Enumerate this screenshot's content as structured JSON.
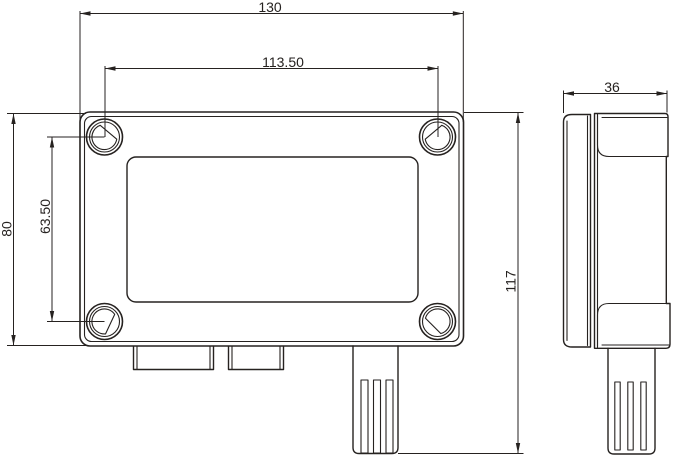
{
  "drawing": {
    "kind": "technical-dimension-drawing",
    "colors": {
      "line": "#262220",
      "background": "#ffffff"
    },
    "dimensions": {
      "overall_width": {
        "label": "130"
      },
      "hole_spacing_h": {
        "label": "113.50"
      },
      "hole_spacing_v": {
        "label": "63.50"
      },
      "body_height": {
        "label": "80"
      },
      "overall_height": {
        "label": "117"
      },
      "depth": {
        "label": "36"
      }
    }
  }
}
